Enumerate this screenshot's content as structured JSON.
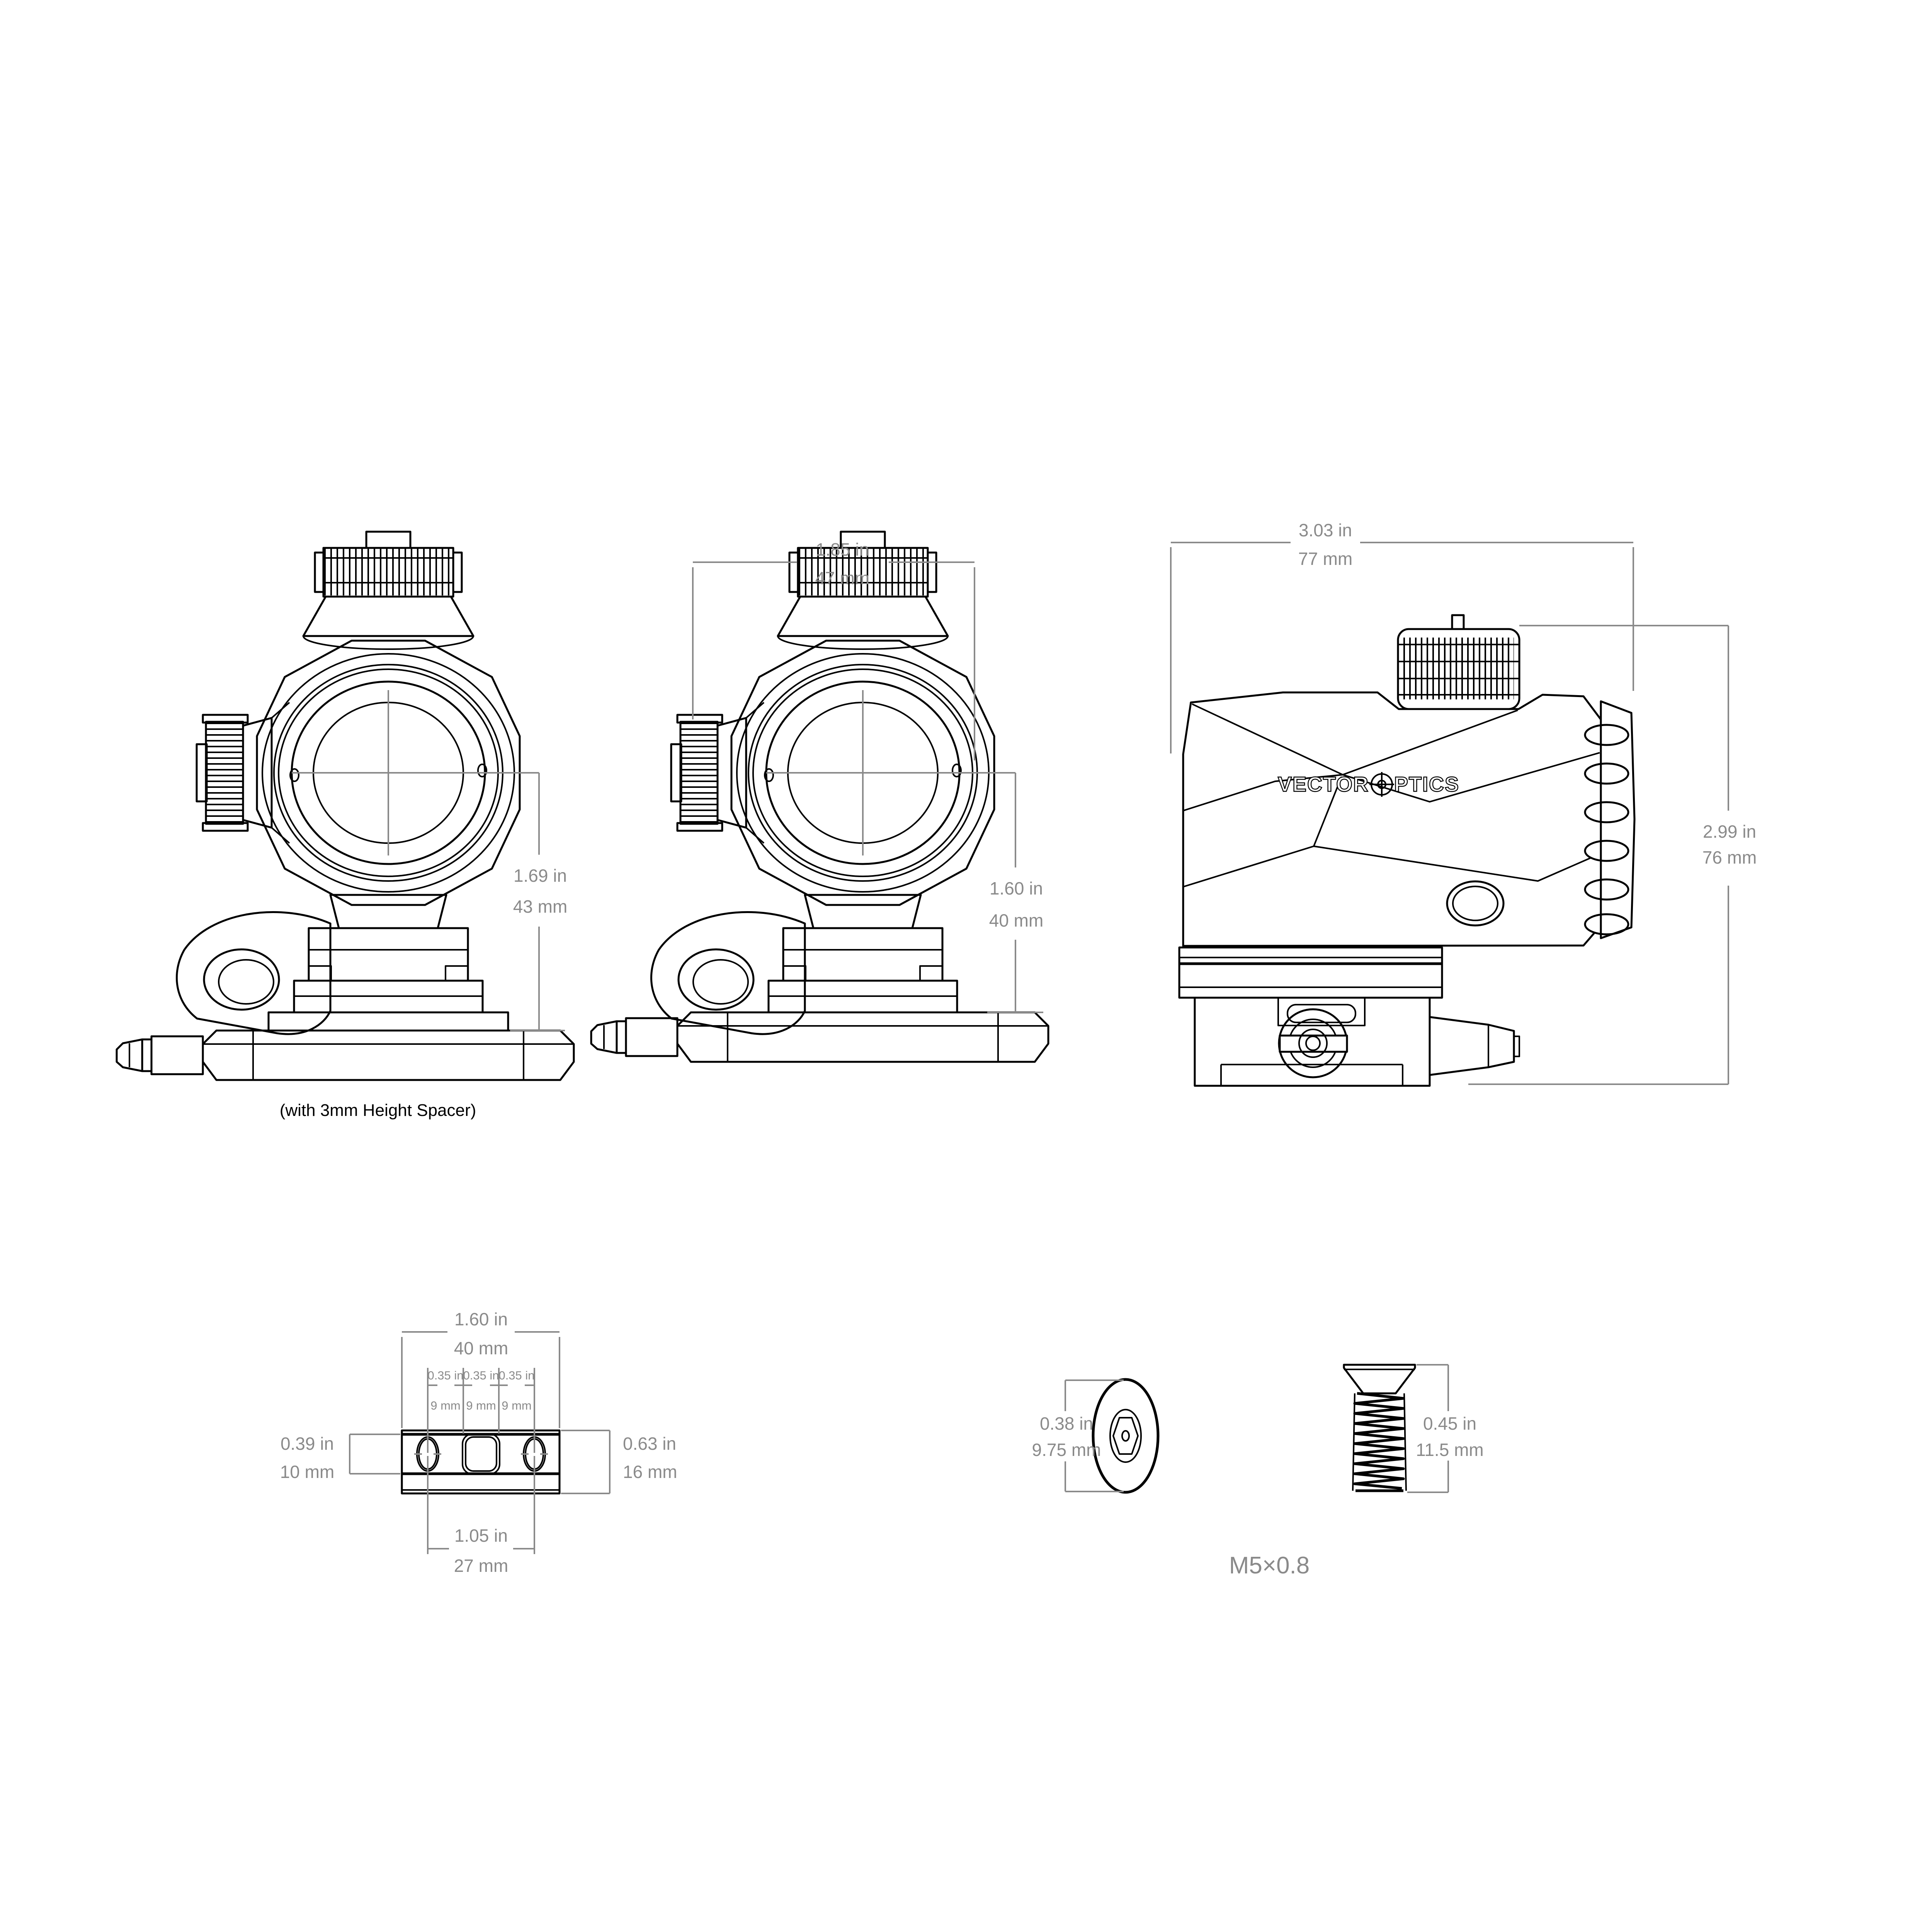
{
  "drawing": {
    "background": "#ffffff",
    "line_color": "#000000",
    "dimension_color": "#8a8a8a",
    "brand": {
      "name": "Vector Optics",
      "word1": "VECTOR",
      "word2": "PTICS"
    },
    "caption_spacer": "(with 3mm Height Spacer)",
    "thread_spec": "M5×0.8",
    "dims": {
      "front_height_spacer": {
        "in": "1.69 in",
        "mm": "43 mm"
      },
      "front_width": {
        "in": "1.85 in",
        "mm": "47 mm"
      },
      "front_height": {
        "in": "1.60 in",
        "mm": "40 mm"
      },
      "side_width": {
        "in": "3.03 in",
        "mm": "77 mm"
      },
      "side_height": {
        "in": "2.99 in",
        "mm": "76 mm"
      },
      "rail_width": {
        "in": "1.60 in",
        "mm": "40 mm"
      },
      "rail_pitch1": {
        "in": "0.35 in",
        "mm": "9 mm"
      },
      "rail_pitch2": {
        "in": "0.35 in",
        "mm": "9 mm"
      },
      "rail_pitch3": {
        "in": "0.35 in",
        "mm": "9 mm"
      },
      "rail_inner_height": {
        "in": "0.39 in",
        "mm": "10 mm"
      },
      "rail_outer_height": {
        "in": "0.63 in",
        "mm": "16 mm"
      },
      "rail_hole_span": {
        "in": "1.05 in",
        "mm": "27 mm"
      },
      "screw_head_diameter": {
        "in": "0.38 in",
        "mm": "9.75 mm"
      },
      "screw_length": {
        "in": "0.45 in",
        "mm": "11.5 mm"
      }
    }
  }
}
